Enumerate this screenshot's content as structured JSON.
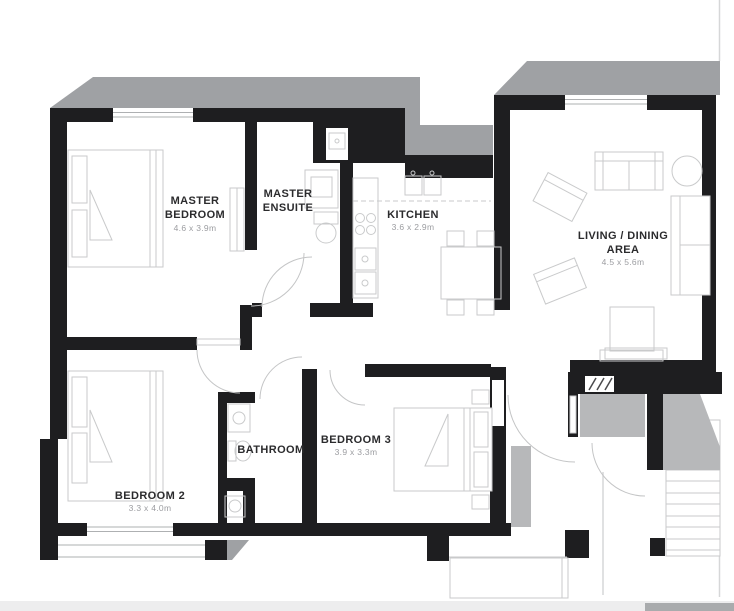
{
  "floor_plan": {
    "rooms": {
      "master_bedroom": {
        "name_line1": "MASTER",
        "name_line2": "BEDROOM",
        "dims": "4.6 x 3.9m"
      },
      "master_ensuite": {
        "name_line1": "MASTER",
        "name_line2": "ENSUITE"
      },
      "kitchen": {
        "name_line1": "KITCHEN",
        "dims": "3.6 x 2.9m"
      },
      "living_dining": {
        "name_line1": "LIVING / DINING",
        "name_line2": "AREA",
        "dims": "4.5 x 5.6m"
      },
      "bedroom_2": {
        "name_line1": "BEDROOM 2",
        "dims": "3.3 x 4.0m"
      },
      "bedroom_3": {
        "name_line1": "BEDROOM 3",
        "dims": "3.9 x 3.3m"
      },
      "bathroom": {
        "name_line1": "BATHROOM"
      }
    },
    "colors": {
      "wall": "#1e1e20",
      "slab_gray": "#9fa1a4",
      "area_gray": "#b7b8ba",
      "furniture_line": "#c9cacb",
      "label_text": "#2b2b2d",
      "dims_text": "#9b9ca0"
    }
  }
}
